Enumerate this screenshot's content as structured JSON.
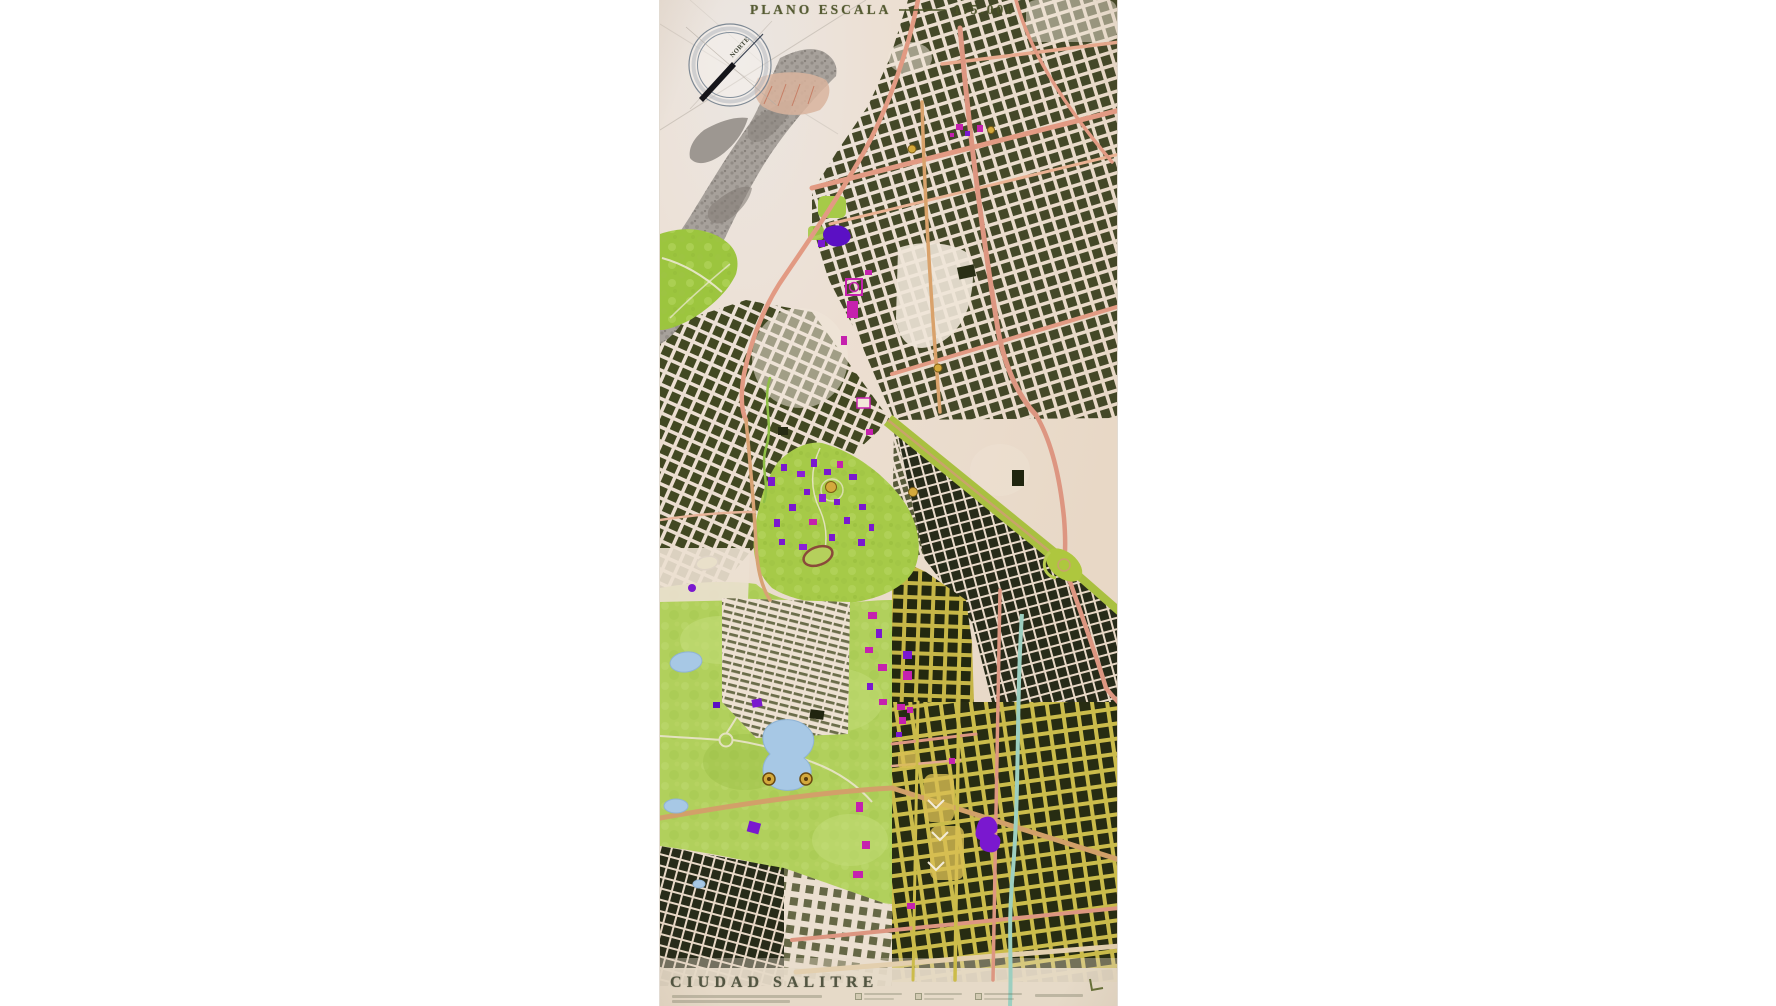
{
  "map": {
    "title": "PLANO ESCALA",
    "scale_label": "1:5.000",
    "compass_label": "NORTE",
    "footer_title": "CIUDAD SALITRE",
    "palette": {
      "paper": "#ecdfd2",
      "city_blocks_olive": "#3b401f",
      "city_blocks_dark": "#1d2210",
      "park_green": "#a6ca48",
      "park_light_green": "#b1d05c",
      "terrain_gray": "#a7a19b",
      "road_salmon": "#e29a83",
      "road_tan": "#d2a069",
      "street_yellow": "#ccbc4a",
      "avenue_green": "#a9c040",
      "building_magenta": "#c521ae",
      "building_purple": "#7a18cf",
      "water_blue": "#a7c8e5",
      "canal_teal": "#9ccfc0",
      "title_ink": "#4a5126"
    }
  }
}
